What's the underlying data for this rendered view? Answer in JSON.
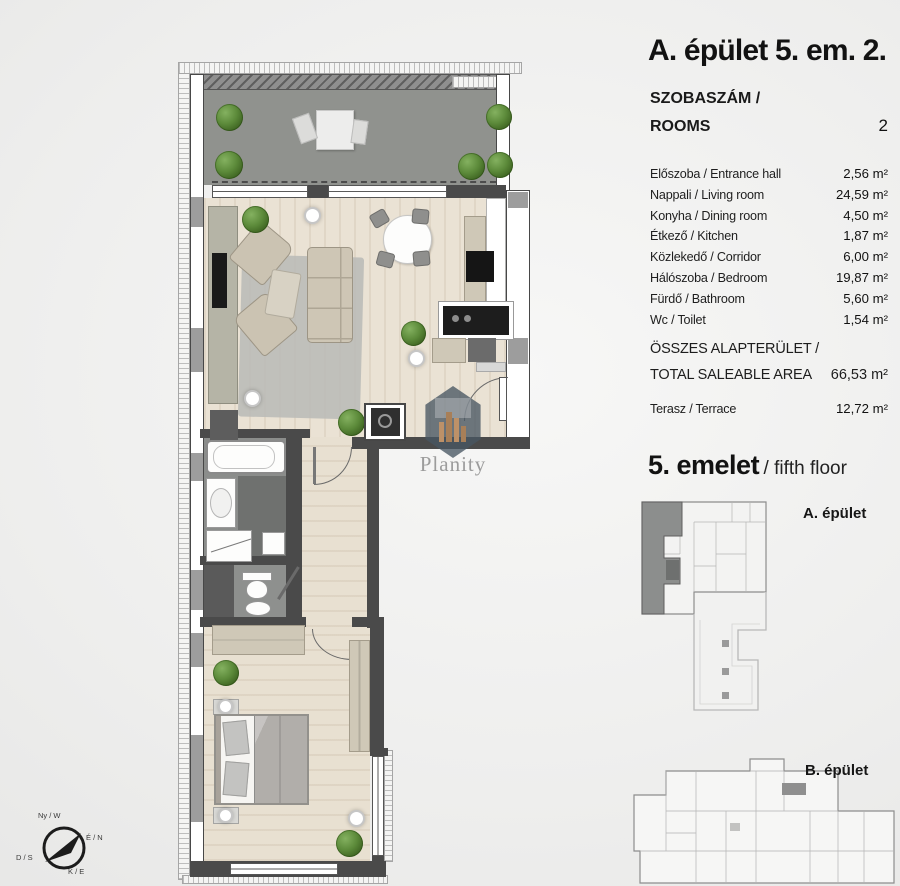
{
  "panel": {
    "title": "A. épület 5. em. 2.",
    "rooms_label_line1": "SZOBASZÁM /",
    "rooms_label_line2": "ROOMS",
    "rooms_value": "2",
    "rows": [
      {
        "label": "Előszoba / Entrance hall",
        "value": "2,56 m²"
      },
      {
        "label": "Nappali / Living room",
        "value": "24,59 m²"
      },
      {
        "label": "Konyha / Dining room",
        "value": "4,50 m²"
      },
      {
        "label": "Étkező / Kitchen",
        "value": "1,87 m²"
      },
      {
        "label": "Közlekedő / Corridor",
        "value": "6,00 m²"
      },
      {
        "label": "Hálószoba / Bedroom",
        "value": "19,87 m²"
      },
      {
        "label": "Fürdő / Bathroom",
        "value": "5,60 m²"
      },
      {
        "label": "Wc / Toilet",
        "value": "1,54 m²"
      }
    ],
    "total_label_line1": "ÖSSZES ALAPTERÜLET /",
    "total_label_line2": "TOTAL SALEABLE AREA",
    "total_value": "66,53 m²",
    "terrace_label": "Terasz / Terrace",
    "terrace_value": "12,72 m²",
    "floor_heading": "5. emelet",
    "floor_heading_suffix": "/ fifth floor",
    "keyplan_a_label": "A. épület",
    "keyplan_b_label": "B. épület"
  },
  "compass": {
    "west": "Ny / W",
    "north": "É / N",
    "south": "D / S",
    "east": "K / E"
  },
  "watermark": {
    "brand": "Planity"
  },
  "colors": {
    "wall": "#474747",
    "terrace_floor": "#90928e",
    "wood_floor": "#eae2d4",
    "highlight_unit": "#8c8e8d",
    "plant_green": "#5c8a3a"
  }
}
